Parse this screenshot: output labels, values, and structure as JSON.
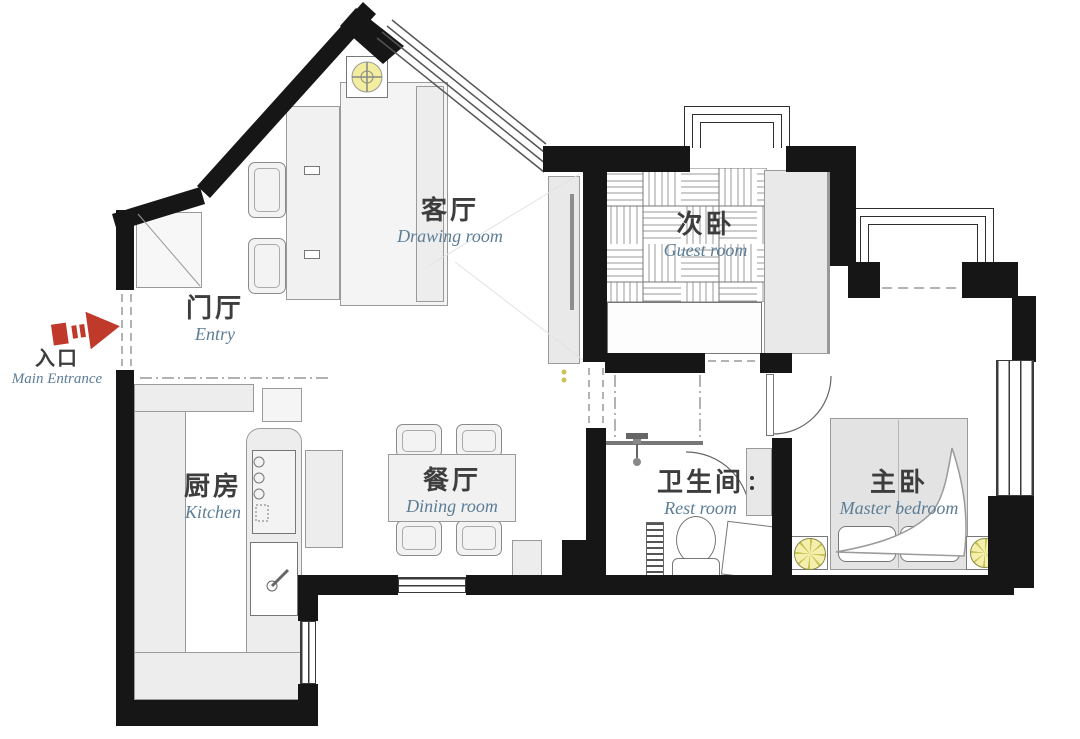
{
  "plan": {
    "rooms": [
      {
        "cn": "客厅",
        "en": "Drawing room"
      },
      {
        "cn": "门厅",
        "en": "Entry"
      },
      {
        "cn": "入口",
        "en": "Main Entrance"
      },
      {
        "cn": "厨房",
        "en": "Kitchen"
      },
      {
        "cn": "餐厅",
        "en": "Dining room"
      },
      {
        "cn": "次卧",
        "en": "Guest room"
      },
      {
        "cn": "卫生间",
        "en": "Rest room"
      },
      {
        "cn": "主卧",
        "en": "Master bedroom"
      }
    ],
    "colors": {
      "wall": "#161616",
      "furniture_fill": "#ededed",
      "line": "#8a8a8a",
      "label_cn": "#3d3d3d",
      "label_en": "#5c7d96",
      "entrance_arrow_red": "#c03a2b",
      "lamp_yellow": "#f4efad"
    },
    "icons": [
      {
        "name": "entrance-arrow-icon",
        "meaning": "main entrance direction arrow"
      },
      {
        "name": "ceiling-lamp-icon",
        "meaning": "ceiling light fixture"
      },
      {
        "name": "wall-lamp-icon",
        "meaning": "bedside lamp"
      }
    ]
  }
}
